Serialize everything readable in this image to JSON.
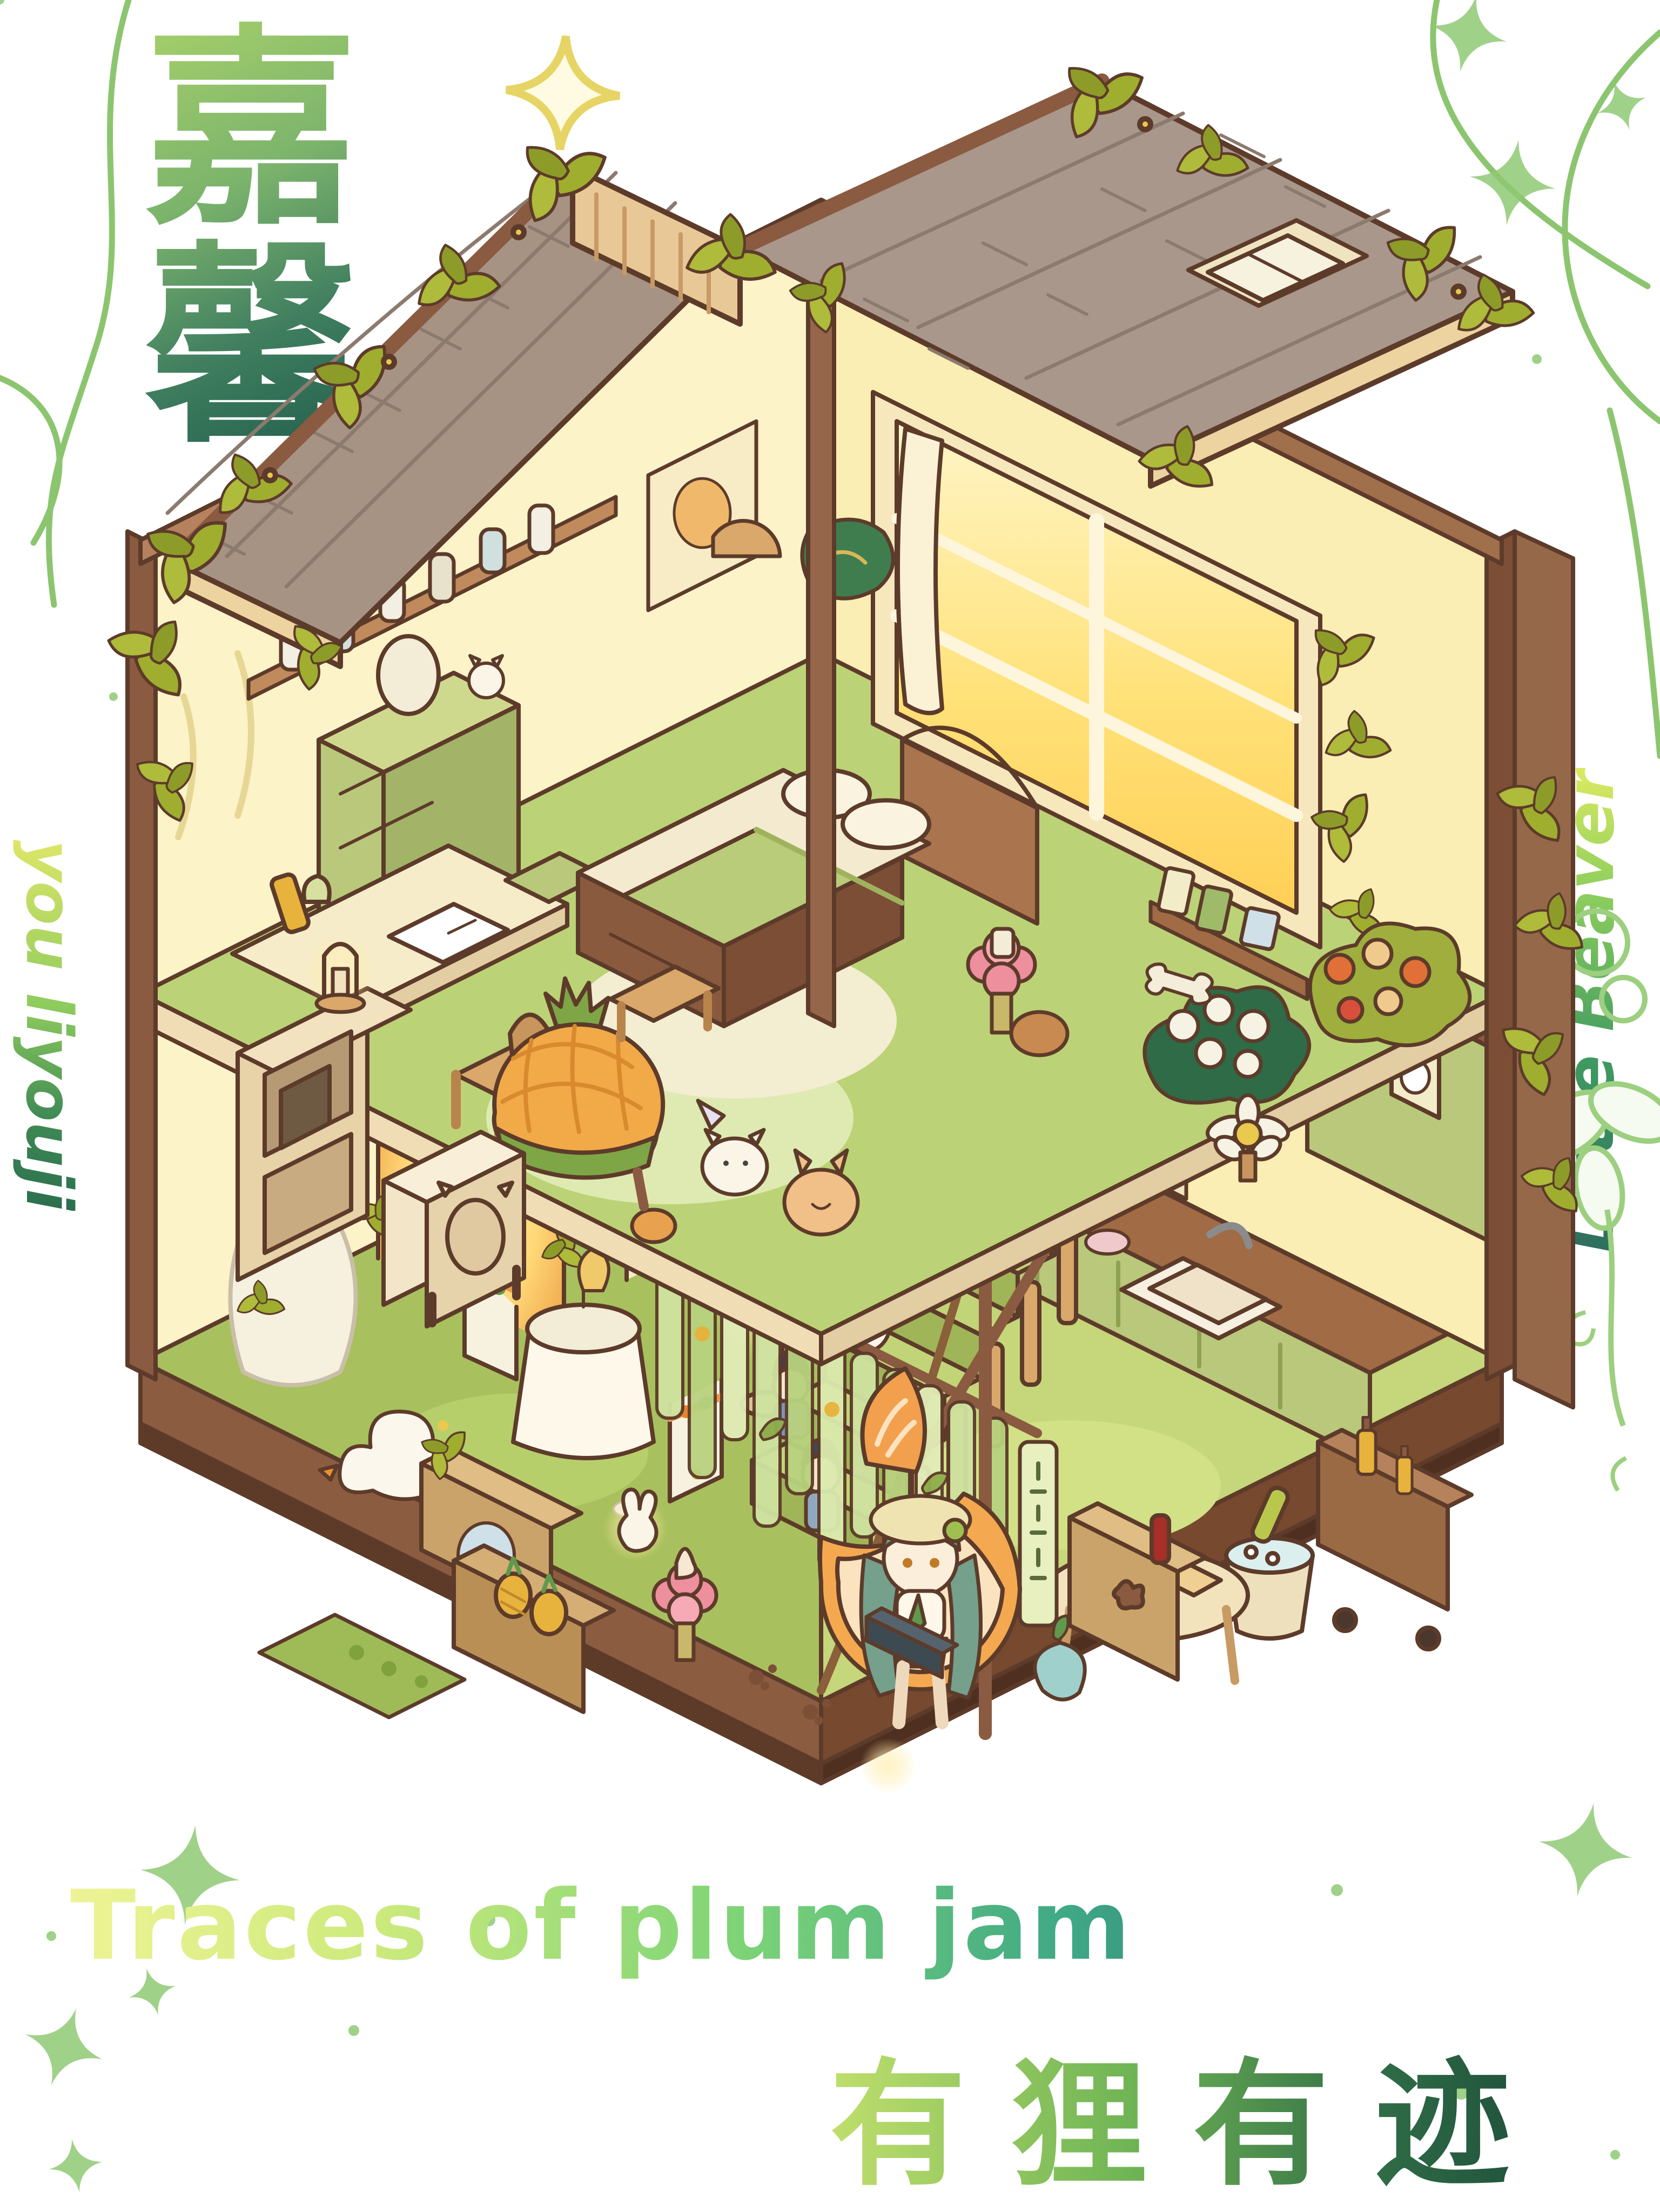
{
  "artwork": {
    "title_cn": "嘉馨",
    "title_cn_chars": [
      "嘉",
      "馨"
    ],
    "signature_left": "you liyouji",
    "signature_right": "Little Beaver",
    "title_en": "Traces of plum jam",
    "subtitle_cn": "有狸有迹"
  },
  "palette": {
    "background": "#ffffff",
    "calligraphy_gradient": [
      "#a7d06a",
      "#1e5c4b"
    ],
    "english_title_gradient": [
      "#eef395",
      "#7ed476",
      "#27566b"
    ],
    "subtitle_gradient": [
      "#cbe570",
      "#1e4d3a"
    ],
    "vine_green": "#8cc56f",
    "star_green": "#8fc974",
    "sparkle_yellow": "#e6d465",
    "roof_shingle": "#a59184",
    "wood_trim": "#8a5a41",
    "wall_cream": "#fdf3c8",
    "window_glow": "#ffd95e",
    "floor_green": "#bcd276",
    "grass_green": "#a9c05e",
    "platform_brown": "#8c5c41",
    "accent_pink": "#ee8f9e",
    "pineapple_orange": "#f2a948",
    "kitchen_cabinet_green": "#b9c87a"
  },
  "scene": {
    "type": "isometric-dollhouse-illustration",
    "levels": [
      "bedroom-upper-floor",
      "garden-kitchen-lower-floor"
    ],
    "roof_items": [
      "shingle-roof-left",
      "shingle-roof-right",
      "skylight-window",
      "roof-vent",
      "ivy-vines"
    ],
    "bedroom_items": [
      "glowing-window",
      "curtain",
      "double-bed",
      "pillows",
      "green-blanket",
      "headboard",
      "jar-shelf",
      "poster",
      "green-wardrobe",
      "vanity-mirror",
      "desk-with-open-book",
      "wooden-chair",
      "wall-lamp",
      "wall-art",
      "pink-flower-stool",
      "pineapple-armchair",
      "cream-speaker",
      "microwave-cabinet",
      "candle-lantern",
      "rug",
      "cat-plush",
      "bunny-plush",
      "panda-plush",
      "seal-plush",
      "bear-plush",
      "strawberry",
      "white-flower-bush",
      "rose-bush",
      "daisy-table"
    ],
    "stairs_items": [
      "green-staircase",
      "railing",
      "red-dress-doll",
      "sailor-doll",
      "black-hair-doll",
      "white-cat-doll",
      "sheep-doll",
      "lotus-staff-lamp",
      "cherry-blossom-sprigs"
    ],
    "kitchen_items": [
      "counter",
      "sink",
      "faucet",
      "hot-pot",
      "bottle-shelf",
      "utensil-rail",
      "green-hutch-with-plates",
      "oven-fridge",
      "coffee-machine",
      "bar-cart",
      "champagne-bucket",
      "dessert-table"
    ],
    "garden_items": [
      "glowing-ivy-arch",
      "arched-glass-door",
      "white-statue",
      "cafe-table-with-drink",
      "garland-chairs",
      "goose",
      "floor-lamp",
      "grass-flowers"
    ],
    "lounge_items": [
      "bamboo-slat-curtain",
      "hanging-sign-tablet",
      "pineapple-crates",
      "round-mirror",
      "flower-stool-with-milkshake",
      "bunny-lamp",
      "clover-mat",
      "orange-egg-chair",
      "girl-character",
      "laptop",
      "beret-hat",
      "snack-cabinet",
      "soda-bottle",
      "water-droplet-pet",
      "paw-prints",
      "candle-glow"
    ],
    "decorations": [
      "green-vine-lines",
      "textured-green-stars",
      "yellow-sparkle",
      "flower-line-art"
    ]
  }
}
